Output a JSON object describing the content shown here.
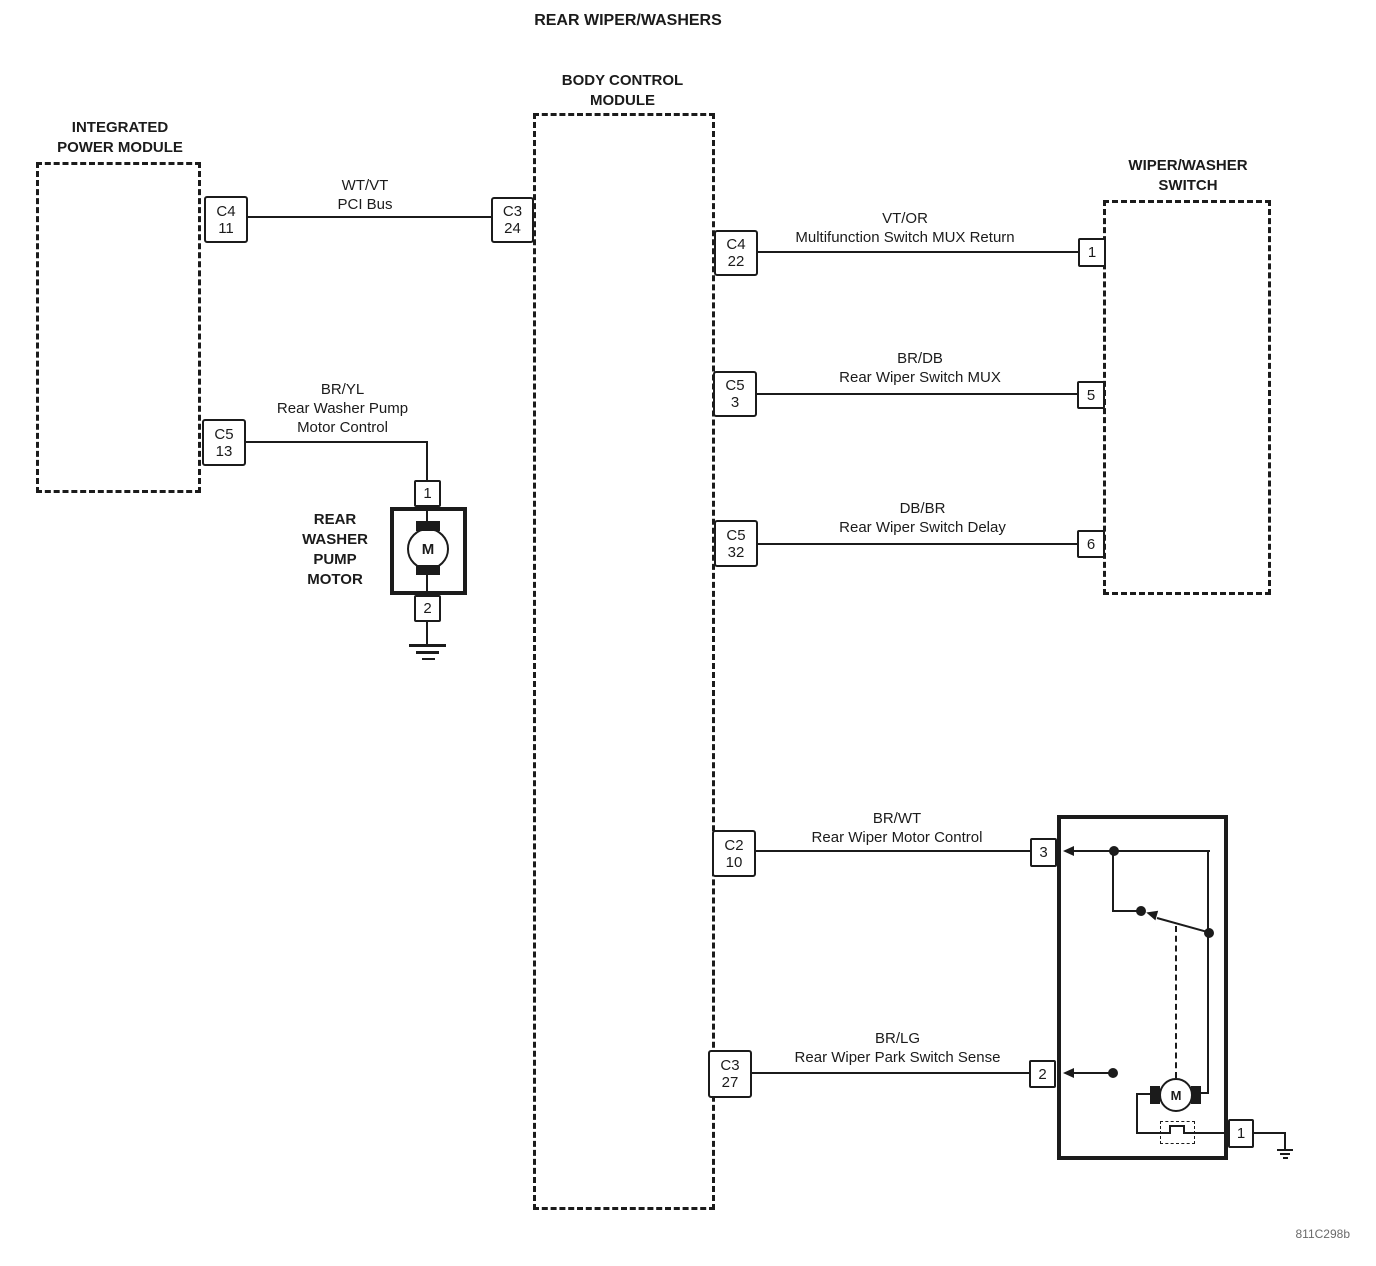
{
  "title": "REAR WIPER/WASHERS",
  "diagram_id": "811C298b",
  "modules": {
    "ipm": {
      "title1": "INTEGRATED",
      "title2": "POWER MODULE"
    },
    "bcm": {
      "title1": "BODY CONTROL",
      "title2": "MODULE"
    },
    "wws": {
      "title1": "WIPER/WASHER",
      "title2": "SWITCH"
    },
    "washer_motor": {
      "l1": "REAR",
      "l2": "WASHER",
      "l3": "PUMP",
      "l4": "MOTOR",
      "symbol": "M"
    },
    "wiper_motor": {
      "symbol": "M"
    }
  },
  "connectors": {
    "ipm_c4": {
      "name": "C4",
      "pin": "11"
    },
    "ipm_c5": {
      "name": "C5",
      "pin": "13"
    },
    "bcm_c3_24": {
      "name": "C3",
      "pin": "24"
    },
    "bcm_c4_22": {
      "name": "C4",
      "pin": "22"
    },
    "bcm_c5_3": {
      "name": "C5",
      "pin": "3"
    },
    "bcm_c5_32": {
      "name": "C5",
      "pin": "32"
    },
    "bcm_c2_10": {
      "name": "C2",
      "pin": "10"
    },
    "bcm_c3_27": {
      "name": "C3",
      "pin": "27"
    }
  },
  "pins": {
    "wws_1": "1",
    "wws_5": "5",
    "wws_6": "6",
    "washer_1": "1",
    "washer_2": "2",
    "wiper_3": "3",
    "wiper_2": "2",
    "wiper_1": "1"
  },
  "wires": {
    "pci": {
      "code": "WT/VT",
      "name": "PCI Bus"
    },
    "washer_pump": {
      "code": "BR/YL",
      "name1": "Rear Washer Pump",
      "name2": "Motor Control"
    },
    "mux_return": {
      "code": "VT/OR",
      "name": "Multifunction Switch MUX Return"
    },
    "wiper_mux": {
      "code": "BR/DB",
      "name": "Rear Wiper Switch MUX"
    },
    "wiper_delay": {
      "code": "DB/BR",
      "name": "Rear Wiper Switch Delay"
    },
    "motor_control": {
      "code": "BR/WT",
      "name": "Rear Wiper Motor Control"
    },
    "park_sense": {
      "code": "BR/LG",
      "name": "Rear Wiper Park Switch Sense"
    }
  }
}
